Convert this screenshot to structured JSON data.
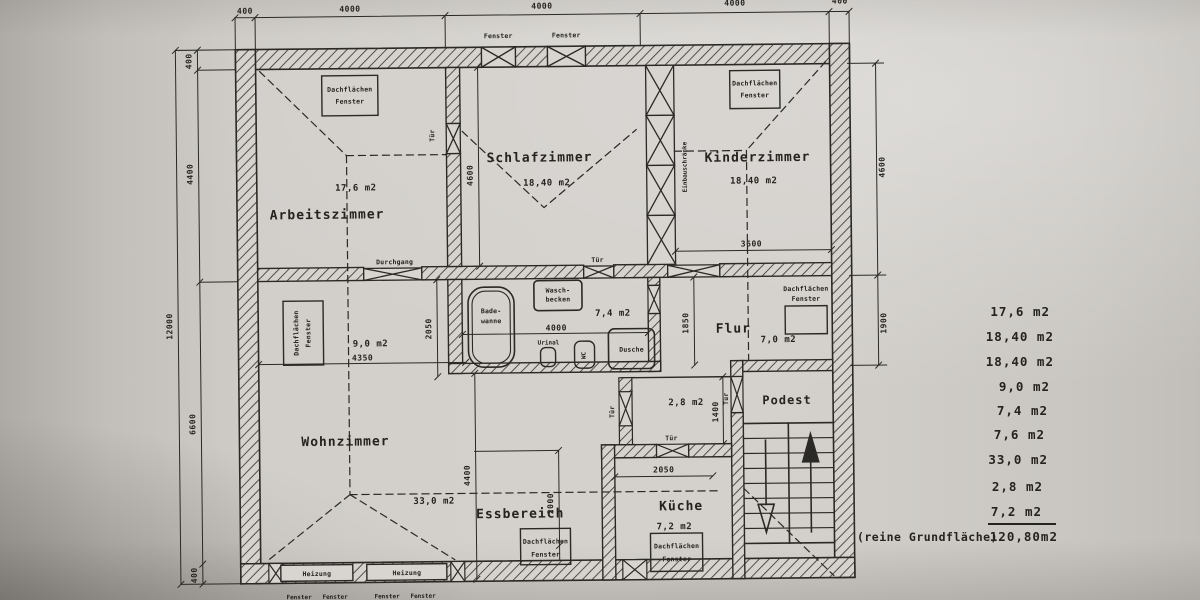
{
  "document": {
    "kind": "scanned architectural floor plan (Dachgeschoss / attic apartment)",
    "language": "German"
  },
  "rooms": {
    "arbeitszimmer": {
      "name": "Arbeitszimmer",
      "area": "17,6 m2"
    },
    "schlafzimmer": {
      "name": "Schlafzimmer",
      "area": "18,40 m2"
    },
    "kinderzimmer": {
      "name": "Kinderzimmer",
      "area": "18,40 m2"
    },
    "bad": {
      "area": "7,4 m2"
    },
    "flur": {
      "name": "Flur",
      "area": "7,0 m2"
    },
    "wohnbereich": {
      "area": "9,0 m2"
    },
    "wohnzimmer": {
      "name": "Wohnzimmer",
      "area": "33,0 m2"
    },
    "abstellraum": {
      "area": "2,8 m2"
    },
    "essbereich": {
      "name": "Essbereich"
    },
    "kueche": {
      "name": "Küche",
      "area": "7,2 m2"
    },
    "podest": {
      "name": "Podest"
    }
  },
  "labels": {
    "fenster": "Fenster",
    "tuer": "Tür",
    "durchgang": "Durchgang",
    "heizung": "Heizung",
    "einbauschraenke": "Einbauschränke",
    "dachflaechen": "Dachflächen",
    "bade1": "Bade-",
    "bade2": "wanne",
    "wasch1": "Wasch-",
    "wasch2": "becken",
    "urinal": "Urinal",
    "wc": "WC",
    "dusche": "Dusche"
  },
  "dims": {
    "top": [
      "400",
      "4000",
      "4000",
      "4000",
      "400"
    ],
    "left_total": "12000",
    "left": [
      "400",
      "4400",
      "6600",
      "400"
    ],
    "right": [
      "4600",
      "1900"
    ],
    "schlafzimmer_hoehe": "4600",
    "kinderzimmer_breite": "3600",
    "bad_breite": "4000",
    "links_breite": "4350",
    "links_hoehe": "2050",
    "flur_hoehe": "1850",
    "wohnzimmer_hoehe": "4400",
    "essbereich_hoehe": "2000",
    "abstellraum_hoehe": "1400",
    "kueche_breite": "2050"
  },
  "area_list": {
    "entries": [
      "17,6 m2",
      "18,40 m2",
      "18,40 m2",
      "9,0 m2",
      "7,4 m2",
      "7,6 m2",
      "33,0 m2",
      "2,8 m2",
      "7,2 m2"
    ],
    "total_label": "(reine Grundfläche)",
    "total_value": "120,80m2"
  }
}
